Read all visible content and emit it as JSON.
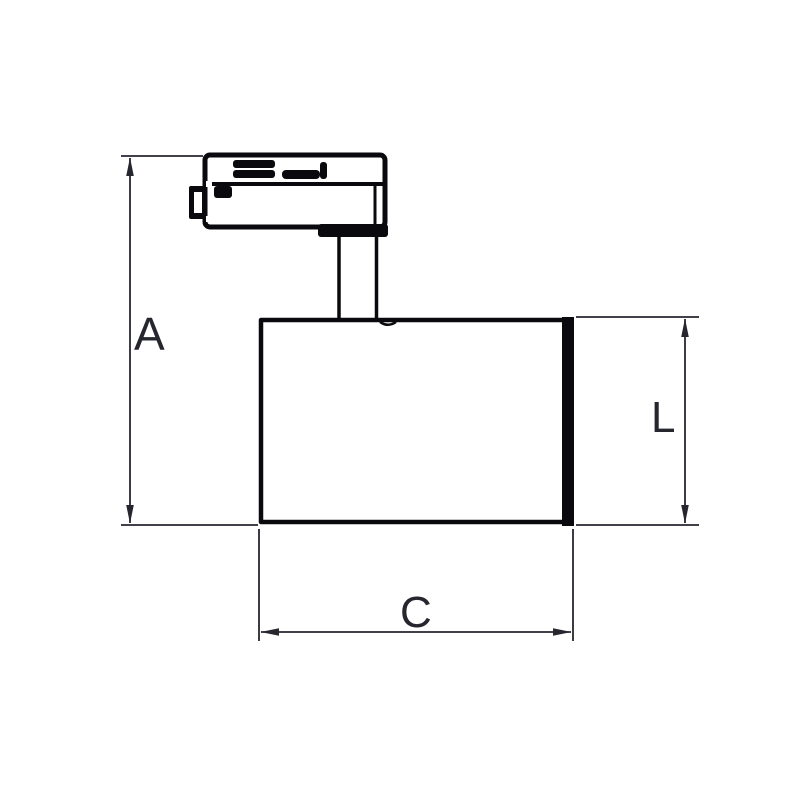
{
  "drawing": {
    "type": "technical-dimension-drawing",
    "subject": "track-mounted-spotlight-side-view",
    "background_color": "#ffffff",
    "line_color": "#0a0a0e",
    "dimension_color": "#26262f",
    "label_color": "#26262f",
    "parts": [
      "track-adapter",
      "adapter-latch-tab",
      "mounting-flange",
      "stem",
      "lamp-body"
    ],
    "dimensions": [
      {
        "label": "A",
        "orientation": "vertical"
      },
      {
        "label": "L",
        "orientation": "vertical"
      },
      {
        "label": "C",
        "orientation": "horizontal"
      }
    ]
  }
}
